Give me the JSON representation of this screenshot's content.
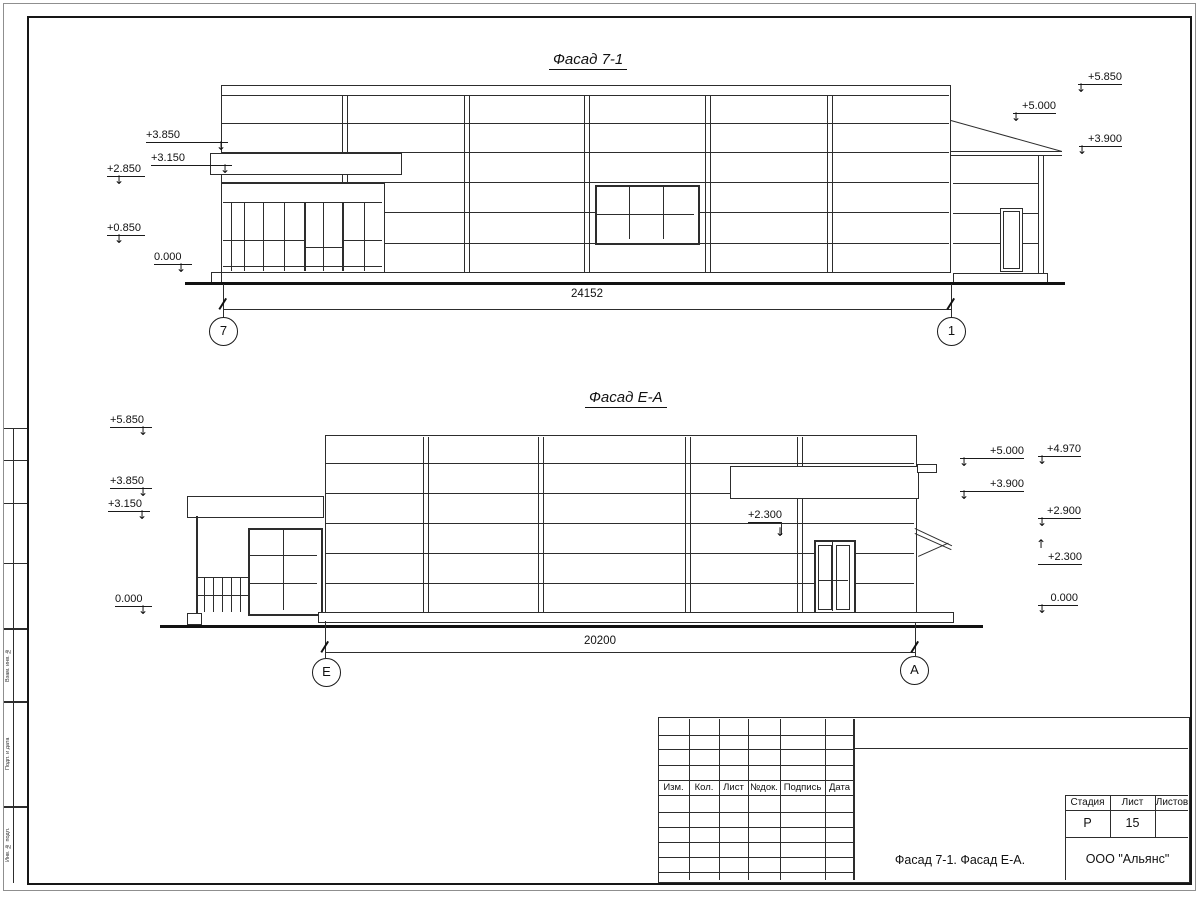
{
  "drawing": {
    "facade1": {
      "title": "Фасад 7-1",
      "dimension": "24152",
      "axis_left": "7",
      "axis_right": "1",
      "marks_left": [
        "+3.850",
        "+3.150",
        "+2.850",
        "+0.850",
        "0.000"
      ],
      "marks_right": [
        "+5.850",
        "+5.000",
        "+3.900"
      ]
    },
    "facade2": {
      "title": "Фасад Е-А",
      "dimension": "20200",
      "axis_left": "Е",
      "axis_right": "А",
      "marks_left": [
        "+5.850",
        "+3.850",
        "+3.150",
        "0.000"
      ],
      "mark_mid": "+2.300",
      "marks_right": [
        "+5.000",
        "+4.970",
        "+3.900",
        "+2.900",
        "+2.300",
        "0.000"
      ]
    },
    "title_block": {
      "rev_headers": [
        "Изм.",
        "Кол.",
        "Лист",
        "№док.",
        "Подпись",
        "Дата"
      ],
      "stage_label": "Стадия",
      "sheet_label": "Лист",
      "sheets_label": "Листов",
      "stage_value": "Р",
      "sheet_value": "15",
      "doc_title": "Фасад 7-1. Фасад Е-А.",
      "org": "ООО \"Альянс\""
    },
    "side_strip": {
      "labels": [
        "Взам. инв. №",
        "Подп. и дата",
        "Инв. № подл."
      ]
    }
  }
}
